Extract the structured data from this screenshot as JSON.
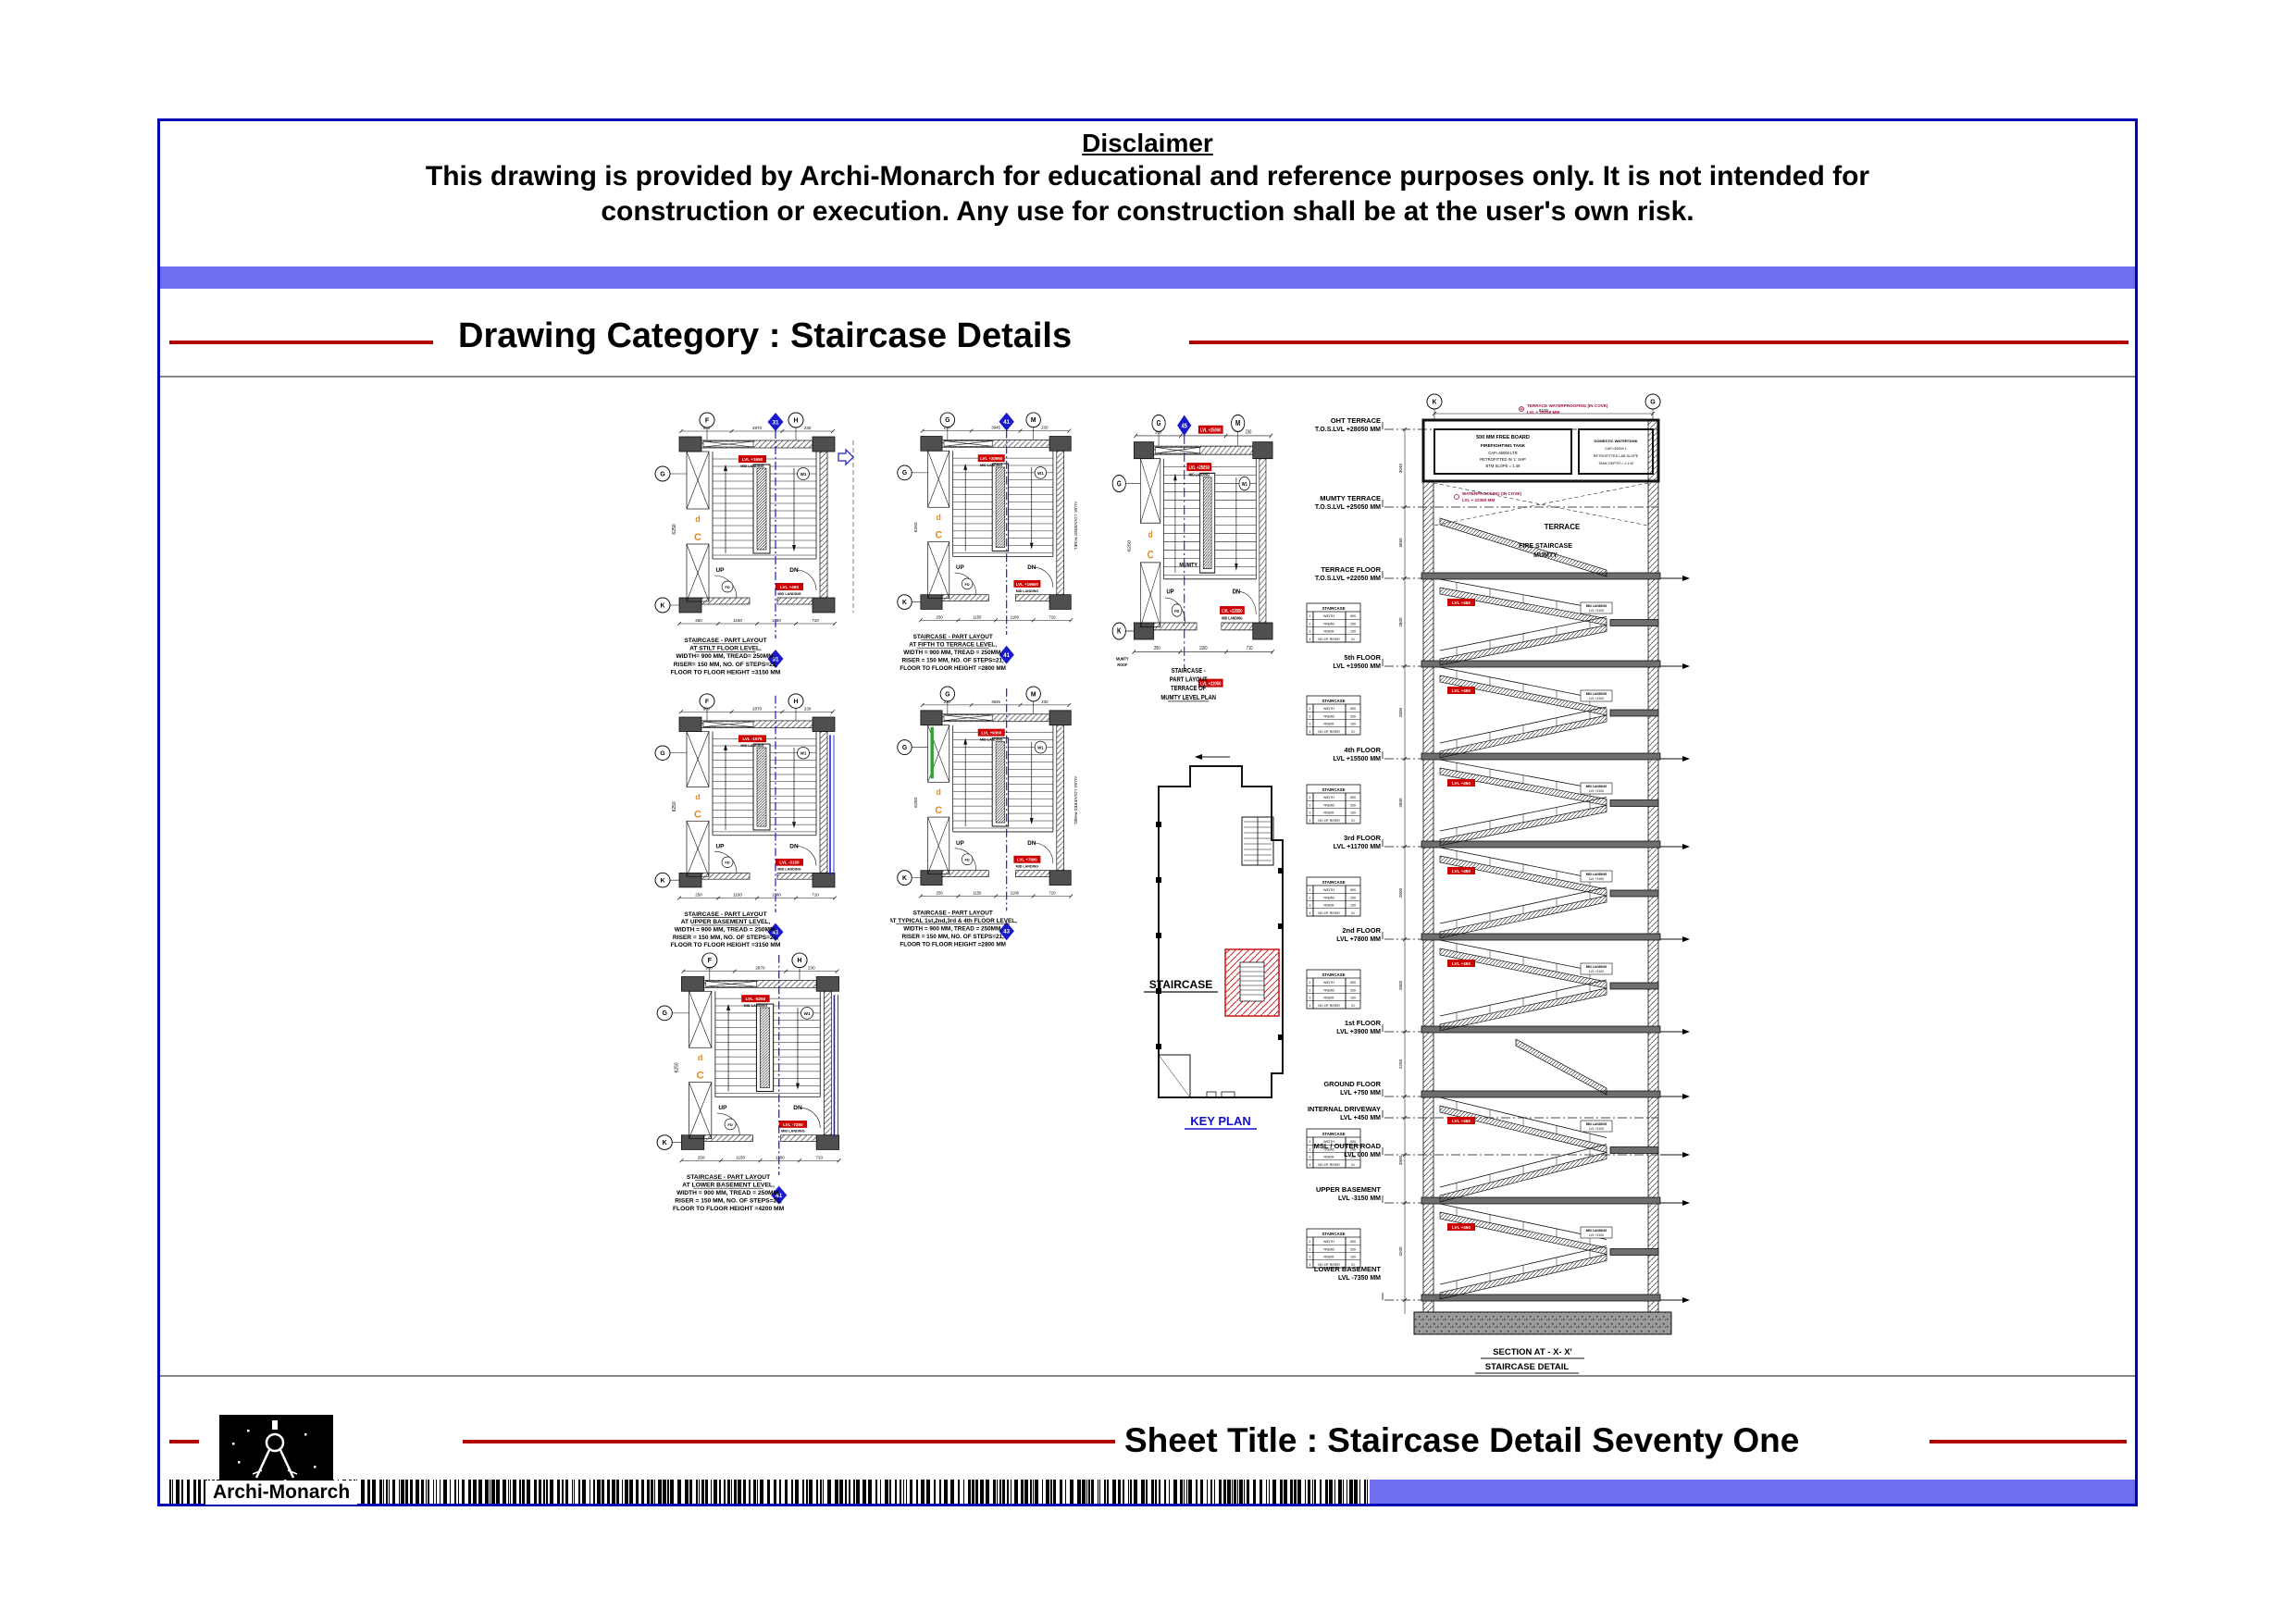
{
  "colors": {
    "frame": "#0000b3",
    "accent_bar": "#6e6ef0",
    "rule_red": "#b00000",
    "rule_gray": "#888888",
    "marker_blue": "#1a1acc",
    "tag_red": "#cc0000",
    "hatch_red": "#cc2222",
    "orange": "#e08a1e",
    "green": "#2fa12f",
    "maroon": "#991144",
    "wall_dark": "#4f4f4f",
    "slab_gray": "#6e6e6e"
  },
  "disclaimer": {
    "title": "Disclaimer",
    "line1": "This drawing is provided by Archi-Monarch for educational and reference purposes only. It is not intended for",
    "line2": "construction or execution. Any use for construction shall be at the user's own risk."
  },
  "category": {
    "label": "Drawing Category : Staircase Details"
  },
  "footer": {
    "sheet_title": "Sheet Title : Staircase Detail Seventy One",
    "brand": "Archi-Monarch"
  },
  "key_plan": {
    "label": "STAIRCASE",
    "caption": "KEY PLAN"
  },
  "plans": [
    {
      "id": "stilt",
      "caption": [
        "STAIRCASE - PART LAYOUT",
        "AT STILT FLOOR LEVEL,",
        "WIDTH= 900 MM, TREAD= 250MM,",
        "RISER= 150 MM, NO. OF STEPS=21,",
        "FLOOR TO FLOOR HEIGHT =3150 MM"
      ],
      "marker_top": "31",
      "marker_bottom": "31",
      "grid": [
        "F",
        "H",
        "G",
        "K"
      ],
      "tags": [
        "LVL +1650",
        "LVL +450"
      ],
      "tag_sub": "MID LANDING",
      "up": "UP",
      "dn": "DN",
      "wc": "W1",
      "dims_top": [
        "900",
        "2870",
        "230"
      ],
      "dims_bottom": [
        "250",
        "1150",
        "1180",
        "710"
      ],
      "dim_left": "6250"
    },
    {
      "id": "upper-basement",
      "caption": [
        "STAIRCASE - PART LAYOUT",
        "AT UPPER BASEMENT LEVEL,",
        "WIDTH = 900 MM, TREAD = 250MM,",
        "RISER = 150 MM, NO. OF STEPS=21,",
        "FLOOR TO FLOOR HEIGHT =3150 MM"
      ],
      "marker_bottom": "41",
      "grid": [
        "F",
        "H",
        "G",
        "K"
      ],
      "tags": [
        "LVL -1575",
        "LVL -3150"
      ],
      "tag_sub": "MID LANDING",
      "up": "UP",
      "dn": "DN",
      "wc": "W1",
      "dims_top": [
        "900",
        "2870",
        "230"
      ],
      "dims_bottom": [
        "250",
        "1150",
        "1180",
        "710"
      ],
      "dim_left": "6250"
    },
    {
      "id": "lower-basement",
      "caption": [
        "STAIRCASE - PART LAYOUT",
        "AT LOWER BASEMENT LEVEL,",
        "WIDTH = 900 MM, TREAD = 250MM,",
        "RISER = 150 MM, NO. OF STEPS=21,",
        "FLOOR TO FLOOR HEIGHT =4200 MM"
      ],
      "marker_bottom": "41",
      "grid": [
        "F",
        "H",
        "G",
        "K"
      ],
      "tags": [
        "LVL -5250",
        "LVL -7350"
      ],
      "tag_sub": "MID LANDING",
      "up": "UP",
      "dn": "DN",
      "wc": "W1",
      "dims_top": [
        "900",
        "2870",
        "230"
      ],
      "dims_bottom": [
        "250",
        "1150",
        "1180",
        "710"
      ],
      "dim_left": "6250"
    },
    {
      "id": "fifth-terrace",
      "caption": [
        "STAIRCASE - PART LAYOUT",
        "AT FIFTH TO TERRACE LEVEL,",
        "WIDTH = 900 MM, TREAD = 250MM,",
        "RISER = 150 MM, NO. OF STEPS=21,",
        "FLOOR TO FLOOR HEIGHT =2800 MM"
      ],
      "marker_top": "41",
      "marker_bottom": "41",
      "grid": [
        "G",
        "M",
        "G",
        "K"
      ],
      "tags": [
        "LVL +20950",
        "LVL +19500"
      ],
      "tag_sub": "MID LANDING",
      "up": "UP",
      "dn": "DN",
      "wc": "W1",
      "side_label": "ALUM. LOUVERED PANEL",
      "dims_top": [
        "230",
        "3945",
        "230"
      ],
      "dims_bottom": [
        "250",
        "1150",
        "1180",
        "710"
      ],
      "dim_left": "6250"
    },
    {
      "id": "typical",
      "caption": [
        "STAIRCASE - PART LAYOUT",
        "AT TYPICAL 1st,2nd,3rd & 4th FLOOR LEVEL,",
        "WIDTH = 900 MM, TREAD = 250MM,",
        "RISER = 150 MM, NO. OF STEPS=21,",
        "FLOOR TO FLOOR HEIGHT =2800 MM"
      ],
      "marker_bottom": "43",
      "grid": [
        "G",
        "M",
        "G",
        "K"
      ],
      "tags": [
        "LVL +9300",
        "LVL +7800"
      ],
      "tag_sub": "MID LANDING",
      "up": "UP",
      "dn": "DN",
      "wc": "W1",
      "side_label": "ALUM. LOUVERED PANEL",
      "dims_top": [
        "230",
        "3945",
        "230"
      ],
      "dims_bottom": [
        "250",
        "1150",
        "1180",
        "710"
      ],
      "dim_left": "6250"
    },
    {
      "id": "mumty",
      "caption": [
        "STAIRCASE -",
        "PART LAYOUT",
        "TERRACE OF",
        "MUMTY LEVEL PLAN"
      ],
      "marker_top": "45",
      "grid": [
        "G",
        "M",
        "G",
        "K"
      ],
      "tags": [
        "LVL +25050",
        "LVL +22050"
      ],
      "tag_sub": "MID LANDING",
      "up": "UP",
      "dn": "DN",
      "wc": "W1",
      "inner_label": "MUMTY",
      "outer_label1": "MUMTY",
      "outer_label2": "ROOF",
      "dims_top": [
        "230",
        "3945",
        "230"
      ],
      "dims_bottom": [
        "250",
        "1150",
        "710"
      ],
      "dim_left": "6250"
    }
  ],
  "section": {
    "grid": [
      "K",
      "G"
    ],
    "top_dim": "8100",
    "caption_line1": "SECTION AT - X- X'",
    "caption_line2": "STAIRCASE DETAIL",
    "floors": [
      {
        "name": "OHT TERRACE",
        "lvl": "T.O.S.LVL +28050 MM"
      },
      {
        "name": "MUMTY TERRACE",
        "lvl": "T.O.S.LVL +25050 MM"
      },
      {
        "name": "TERRACE FLOOR",
        "lvl": "T.O.S.LVL +22050 MM"
      },
      {
        "name": "5th FLOOR",
        "lvl": "LVL +19500 MM"
      },
      {
        "name": "4th FLOOR",
        "lvl": "LVL +15500 MM"
      },
      {
        "name": "3rd FLOOR",
        "lvl": "LVL +11700 MM"
      },
      {
        "name": "2nd FLOOR",
        "lvl": "LVL +7800 MM"
      },
      {
        "name": "1st FLOOR",
        "lvl": "LVL +3900 MM"
      },
      {
        "name": "GROUND FLOOR",
        "lvl": "LVL +750 MM"
      },
      {
        "name": "INTERNAL DRIVEWAY",
        "lvl": "LVL +450 MM"
      },
      {
        "name": "MSL / OUTER ROAD",
        "lvl": "LVL 000 MM"
      },
      {
        "name": "UPPER BASEMENT",
        "lvl": "LVL -3150 MM"
      },
      {
        "name": "LOWER BASEMENT",
        "lvl": "LVL -7350 MM"
      }
    ],
    "dim_values": [
      "3040",
      "3050",
      "2800",
      "2800",
      "2800",
      "2800",
      "2800",
      "2250",
      "3900",
      "4200"
    ],
    "tank": {
      "freeboard": "500 MM FREE BOARD",
      "l1": "FIREFIGHTING TANK",
      "l2": "CAP=45000 LTR",
      "l3": "RETROFITTED IN 'L' SHP",
      "l4": "BTM SLOPE = 1:48",
      "r1": "DOMESTIC WATERTANK",
      "r2": "CAP=30000 L",
      "r3": "RETROFITTED L&B SLOPE",
      "r4": "TANK DEPTH = 1.4 M"
    },
    "notes": {
      "terrace": "TERRACE",
      "mumty1": "FIRE STAIRCASE",
      "mumty2": "MUMTY",
      "wp1": "TERRACE WATERPROOFING (IN COVE)",
      "wp1b": "LVL + 25250 MM",
      "wp2": "WATERPROOFING (IN COVE)",
      "wp2b": "LVL + 22350 MM"
    },
    "tags": {
      "flight": "LVL +450",
      "landing1": "MID LANDING",
      "landing2": "LVL +2100"
    },
    "schedule": {
      "title": "STAIRCASE",
      "rows": [
        [
          "1",
          "WIDTH",
          "900"
        ],
        [
          "2",
          "TREAD",
          "250"
        ],
        [
          "3",
          "RISER",
          "150"
        ],
        [
          "4",
          "NO.OF RISER",
          "21"
        ]
      ]
    }
  }
}
